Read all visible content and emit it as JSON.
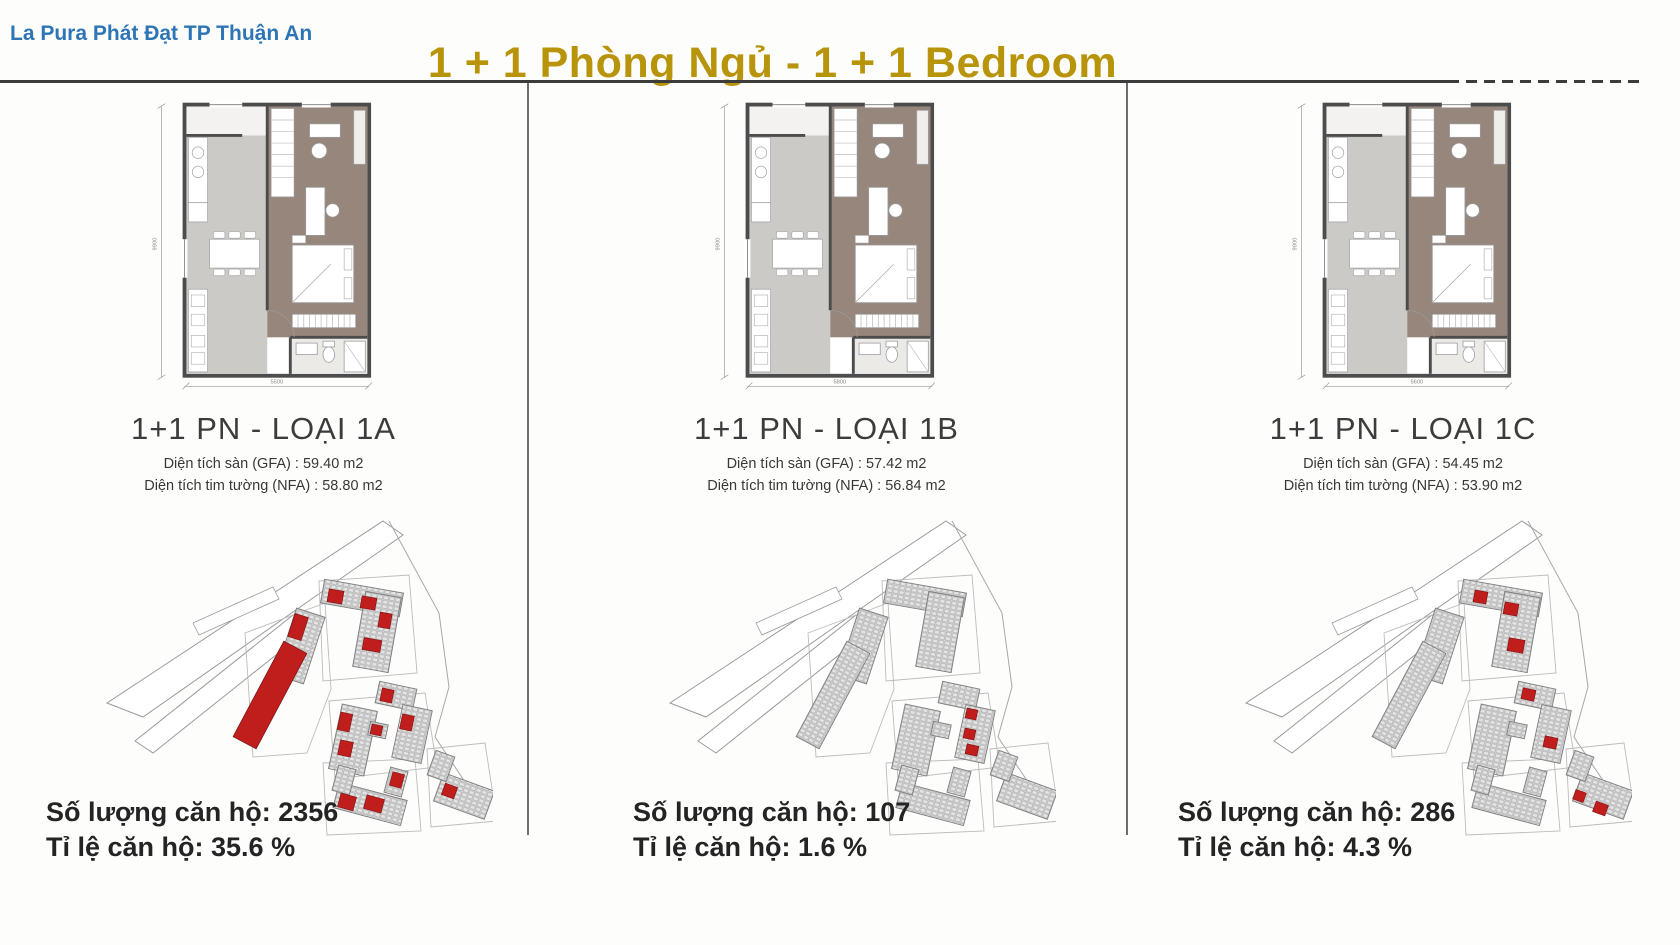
{
  "header": {
    "brand": "La Pura Phát Đạt TP Thuận An",
    "title": "1 + 1 Phòng Ngủ - 1 + 1 Bedroom"
  },
  "colors": {
    "brand_blue": "#2e75b6",
    "title_gold": "#b8940b",
    "highlight_red": "#c01d1d"
  },
  "columns": [
    {
      "title": "1+1 PN - LOẠI 1A",
      "gfa": "Diện tích sàn (GFA) : 59.40 m2",
      "nfa": "Diện tích tim tường (NFA) : 58.80 m2",
      "count": "Số lượng căn hộ: 2356",
      "ratio": "Tỉ lệ căn hộ: 35.6 %",
      "dim_w": "5500",
      "dim_h": "9900",
      "site_highlights": [
        [
          222,
          150,
          26,
          108,
          28
        ],
        [
          256,
          124,
          14,
          24,
          18
        ],
        [
          293,
          99,
          15,
          13,
          10
        ],
        [
          326,
          106,
          15,
          12,
          10
        ],
        [
          328,
          148,
          18,
          12,
          10
        ],
        [
          344,
          122,
          12,
          15,
          10
        ],
        [
          346,
          198,
          12,
          13,
          12
        ],
        [
          366,
          224,
          12,
          15,
          12
        ],
        [
          304,
          222,
          12,
          18,
          12
        ],
        [
          304,
          250,
          13,
          15,
          12
        ],
        [
          336,
          234,
          11,
          10,
          12
        ],
        [
          304,
          304,
          16,
          14,
          15
        ],
        [
          330,
          306,
          18,
          14,
          15
        ],
        [
          356,
          282,
          12,
          14,
          15
        ],
        [
          408,
          294,
          13,
          12,
          20
        ]
      ]
    },
    {
      "title": "1+1 PN - LOẠI 1B",
      "gfa": "Diện tích sàn (GFA) : 57.42 m2",
      "nfa": "Diện tích tim tường (NFA) : 56.84 m2",
      "count": "Số lượng căn hộ: 107",
      "ratio": "Tỉ lệ căn hộ: 1.6 %",
      "dim_w": "5800",
      "dim_h": "9900",
      "site_highlights": [
        [
          368,
          218,
          11,
          10,
          12
        ],
        [
          366,
          238,
          11,
          10,
          12
        ],
        [
          368,
          254,
          12,
          10,
          12
        ]
      ]
    },
    {
      "title": "1+1 PN - LOẠI 1C",
      "gfa": "Diện tích sàn (GFA) : 54.45 m2",
      "nfa": "Diện tích tim tường (NFA) : 53.90 m2",
      "count": "Số lượng căn hộ: 286",
      "ratio": "Tỉ lệ căn hộ: 4.3 %",
      "dim_w": "5600",
      "dim_h": "9900",
      "site_highlights": [
        [
          300,
          100,
          13,
          12,
          10
        ],
        [
          330,
          112,
          14,
          12,
          10
        ],
        [
          334,
          148,
          16,
          13,
          10
        ],
        [
          348,
          198,
          13,
          11,
          12
        ],
        [
          370,
          246,
          13,
          11,
          12
        ],
        [
          400,
          300,
          11,
          10,
          20
        ],
        [
          420,
          312,
          13,
          11,
          20
        ]
      ]
    }
  ]
}
